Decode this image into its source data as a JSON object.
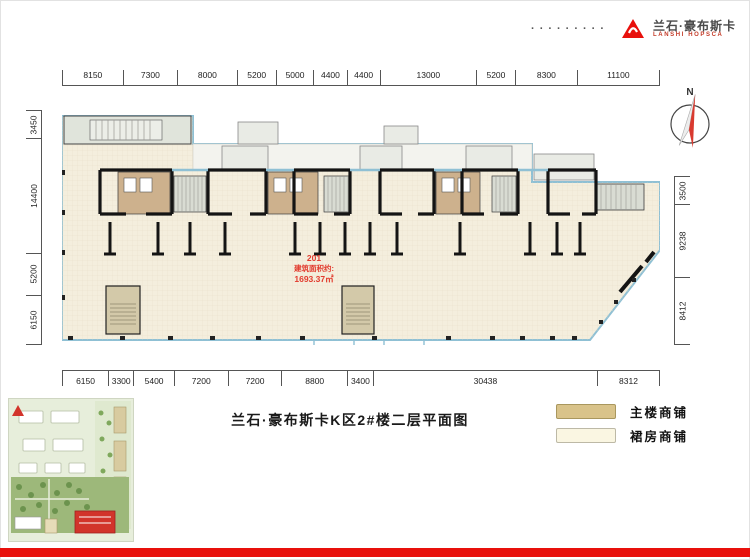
{
  "logo": {
    "dots": "·········",
    "name_cn": "兰石·豪布斯卡",
    "name_en": "LANSHI HOPSCA"
  },
  "compass": {
    "label": "N"
  },
  "dimensions": {
    "top": [
      8150,
      7300,
      8000,
      5200,
      5000,
      4400,
      4400,
      13000,
      5200,
      8300,
      11100
    ],
    "bottom": [
      6150,
      3300,
      5400,
      7200,
      7200,
      8800,
      3400,
      30438,
      8312
    ],
    "left": [
      3450,
      14400,
      5200,
      6150
    ],
    "right": [
      3500,
      9238,
      8412
    ]
  },
  "plan": {
    "unit_label": {
      "number": "201",
      "area_caption": "建筑面积约:",
      "area_value": "1693.37㎡"
    }
  },
  "footer": {
    "title": "兰石·豪布斯卡K区2#楼二层平面图"
  },
  "legend": {
    "items": [
      {
        "label": "主楼商铺",
        "color": "#d9c38a"
      },
      {
        "label": "裙房商铺",
        "color": "#faf6e2"
      }
    ]
  },
  "colors": {
    "accent_red": "#e8100c",
    "floor_cream": "#f4eedd",
    "main_tan": "#cdb18d",
    "window_blue": "#8fc0d4",
    "wall_black": "#141414"
  }
}
